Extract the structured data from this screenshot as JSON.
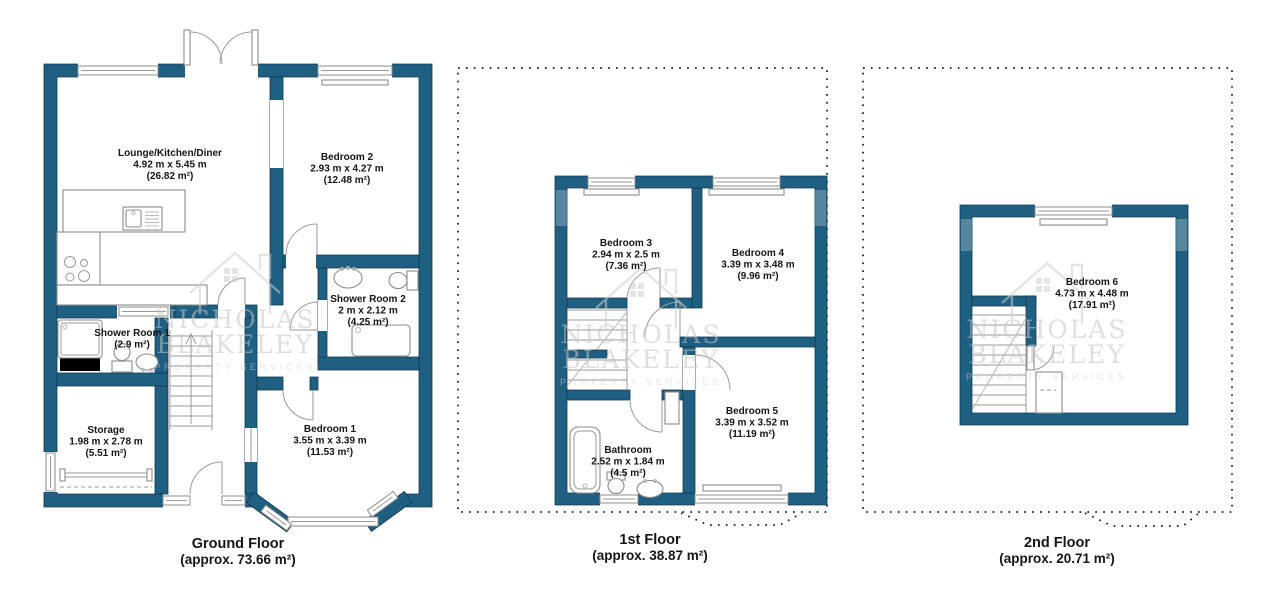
{
  "colors": {
    "wall": "#1E5F82",
    "wall_light": "#57869F",
    "outline": "#123A50",
    "fixture_line": "#8c8c8c",
    "text": "#151515",
    "watermark": "#c6c6c6",
    "background": "#ffffff",
    "chimney_breast": "#000000"
  },
  "watermark": {
    "line1": "NICHOLAS",
    "line2": "BLAKELEY",
    "line3": "PROPERTY SERVICES"
  },
  "floors": [
    {
      "id": "ground-floor",
      "title": "Ground Floor",
      "area": "(approx. 73.66 m²)",
      "rooms": [
        {
          "name": "Lounge/Kitchen/Diner",
          "dims": "4.92 m x 5.45 m",
          "area": "(26.82 m²)"
        },
        {
          "name": "Bedroom 2",
          "dims": "2.93 m x 4.27 m",
          "area": "(12.48 m²)"
        },
        {
          "name": "Shower Room 2",
          "dims": "2 m x 2.12 m",
          "area": "(4.25 m²)"
        },
        {
          "name": "Shower Room 1",
          "dims": "",
          "area": "(2.9 m²)"
        },
        {
          "name": "Storage",
          "dims": "1.98 m x 2.78 m",
          "area": "(5.51 m²)"
        },
        {
          "name": "Bedroom 1",
          "dims": "3.55 m x 3.39 m",
          "area": "(11.53 m²)"
        }
      ]
    },
    {
      "id": "first-floor",
      "title": "1st Floor",
      "area": "(approx. 38.87 m²)",
      "rooms": [
        {
          "name": "Bedroom 3",
          "dims": "2.94 m x 2.5 m",
          "area": "(7.36 m²)"
        },
        {
          "name": "Bedroom 4",
          "dims": "3.39 m x 3.48 m",
          "area": "(9.96 m²)"
        },
        {
          "name": "Bedroom 5",
          "dims": "3.39 m x 3.52 m",
          "area": "(11.19 m²)"
        },
        {
          "name": "Bathroom",
          "dims": "2.52 m x 1.84 m",
          "area": "(4.5 m²)"
        }
      ]
    },
    {
      "id": "second-floor",
      "title": "2nd Floor",
      "area": "(approx. 20.71 m²)",
      "rooms": [
        {
          "name": "Bedroom 6",
          "dims": "4.73 m x 4.48 m",
          "area": "(17.91 m²)"
        }
      ]
    }
  ]
}
